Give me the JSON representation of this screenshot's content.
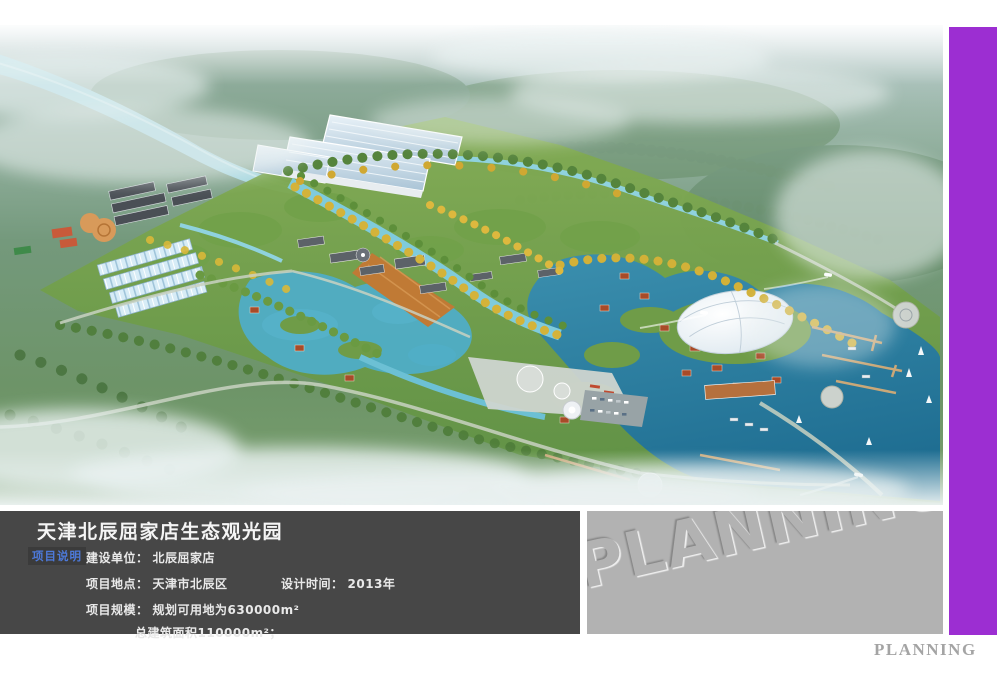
{
  "info_panel": {
    "title": "天津北辰屈家店生态观光园",
    "section_label": "项目说明",
    "fields": [
      {
        "label": "建设单位：",
        "value": "北辰屈家店"
      },
      {
        "label": "项目地点：",
        "value": "天津市北辰区"
      },
      {
        "label": "设计时间：",
        "value": "2013年"
      },
      {
        "label": "项目规模：",
        "value": "规划可用地为630000m²"
      },
      {
        "label": "",
        "value": "总建筑面积110000m²；"
      }
    ]
  },
  "watermark_panel": {
    "text": "PLANNING"
  },
  "footer": {
    "text": "PLANNING"
  },
  "colors": {
    "accent_purple": "#9c2ed2",
    "panel_dark": "#474747",
    "section_label_blue": "#4d79d9",
    "watermark_gray": "#b2b2b2",
    "footer_gray": "#a4a4a4",
    "water_deep": "#1f6e92",
    "water_light": "#7fcbdc",
    "park_green": "#6f9c48"
  }
}
